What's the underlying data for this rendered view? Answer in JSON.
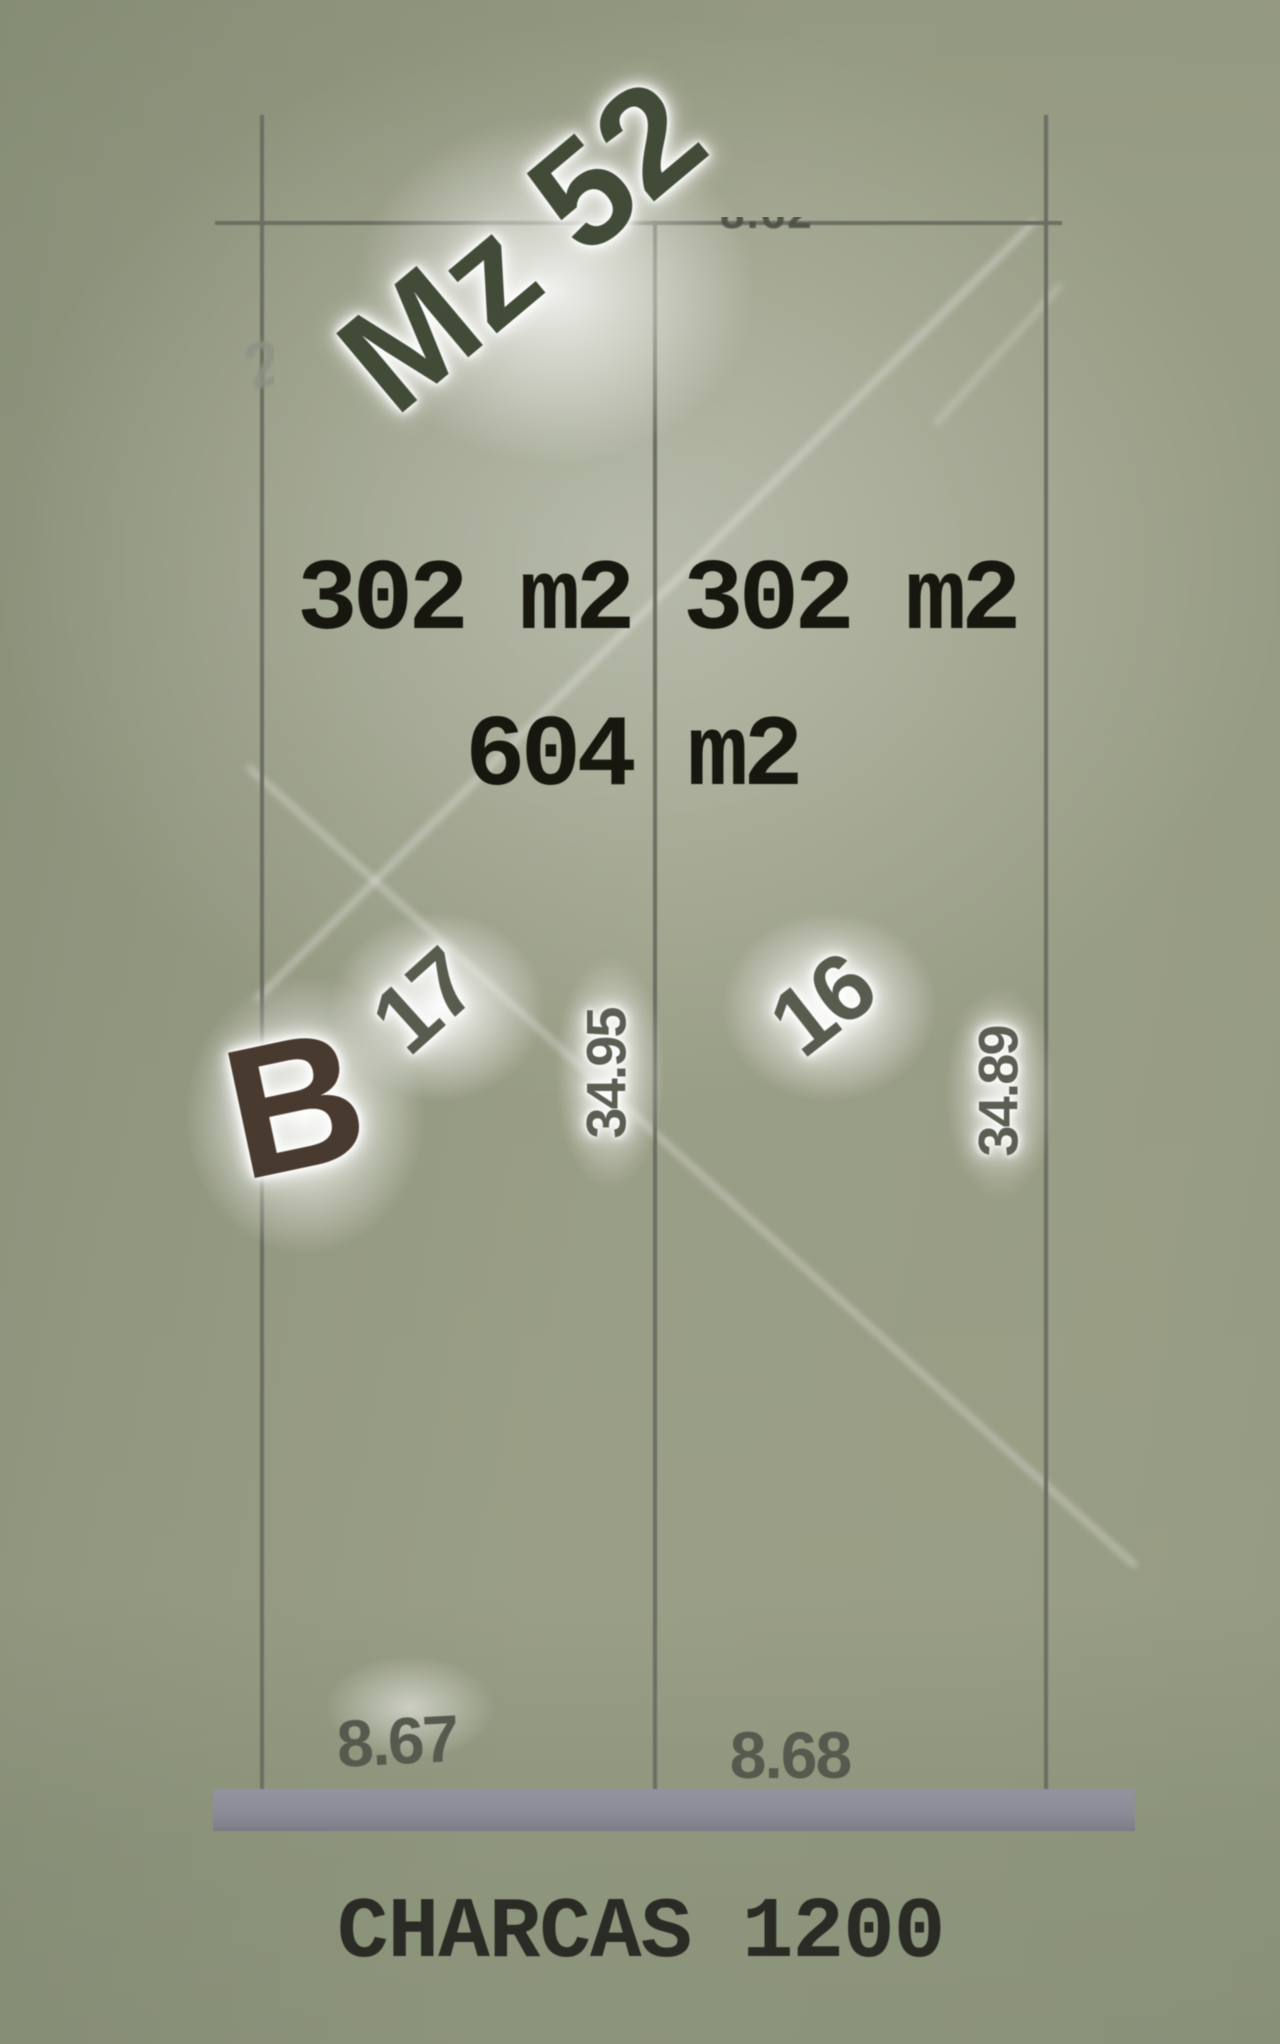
{
  "plan": {
    "block": "Mz 52",
    "zone": "B",
    "total_area": "604 m2",
    "street": "CHARCAS 1200",
    "rear_measure_fragment": "8.62",
    "edge_fragment": "2",
    "lots": [
      {
        "number": "17",
        "area": "302 m2",
        "depth": "34.95",
        "frontage": "8.67"
      },
      {
        "number": "16",
        "area": "302 m2",
        "depth": "34.89",
        "frontage": "8.68"
      }
    ]
  },
  "colors": {
    "background_sage": "#c0c4b4",
    "background_dark_edge": "#b2b8a7",
    "plot_interior": "#c8cbba",
    "boundary_line": "#6b6e61",
    "street_bar": "#8c8c98",
    "block_text": "#424b38",
    "zone_text": "#493a30",
    "lot_number_text": "#575c4f",
    "dimension_text": "#5b5f53",
    "area_text": "#17170f",
    "street_text": "#2b2b26",
    "streak_white": "#ffffff"
  }
}
